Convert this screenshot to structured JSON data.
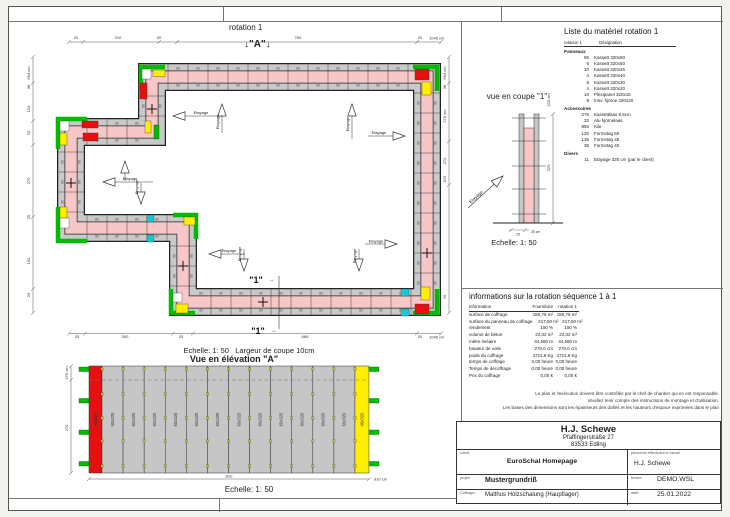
{
  "colors": {
    "wall_pink": "#f7c6c6",
    "panel_gray": "#c9c9c9",
    "green": "#00bb00",
    "red": "#e61010",
    "yellow": "#ffee00",
    "cyan": "#18c8d8",
    "elev_gray": "#c6c6c6"
  },
  "plan": {
    "title": "rotation 1",
    "marker_a": "↓\"A\"↓",
    "marker_1": "\"1\"",
    "marker_arrow": "→",
    "panel_label": "60",
    "etayage_label": "Etayage",
    "scale_note": "Echelle: 1: 50   Largeur de coupe 10cm",
    "dims": {
      "top": [
        "20",
        "210",
        "20",
        "760",
        "20",
        "1045 cm"
      ],
      "left": [
        "664 cm",
        "38",
        "134",
        "20",
        "270",
        "20",
        "190",
        "20"
      ],
      "right": [
        "664 cm",
        "38",
        "270 cm",
        "270",
        "525",
        "20"
      ],
      "bottom": [
        "25",
        "300",
        "25",
        "665",
        "20",
        "1045 cm"
      ]
    }
  },
  "section": {
    "title": "vue en coupe \"1\"",
    "etayage_label": "Etayage",
    "dims": {
      "right": [
        "320 cm",
        "320"
      ],
      "bottom": [
        "25",
        "25 cm"
      ]
    },
    "scale": "Echelle: 1: 50"
  },
  "elevation": {
    "title": "Vue en élévation \"A\"",
    "scale": "Echelle: 1: 50",
    "dims": {
      "left": [
        "270 cm",
        "270"
      ],
      "bottom": [
        "810",
        "810 cm"
      ]
    },
    "panels": [
      {
        "label": "60x320",
        "color": "red"
      },
      {
        "label": "60x320",
        "color": "gray"
      },
      {
        "label": "60x320",
        "color": "gray"
      },
      {
        "label": "60x320",
        "color": "gray"
      },
      {
        "label": "60x320",
        "color": "gray"
      },
      {
        "label": "60x320",
        "color": "gray"
      },
      {
        "label": "60x320",
        "color": "gray"
      },
      {
        "label": "60x320",
        "color": "gray"
      },
      {
        "label": "60x320",
        "color": "gray"
      },
      {
        "label": "60x320",
        "color": "gray"
      },
      {
        "label": "60x320",
        "color": "gray"
      },
      {
        "label": "60x320",
        "color": "gray"
      },
      {
        "label": "60x320",
        "color": "gray"
      },
      {
        "label": "40x320",
        "color": "yellow"
      }
    ]
  },
  "material_list": {
    "title": "Liste du matériel rotation 1",
    "col1": "rotation 1",
    "col2": "Désignation",
    "groups": [
      {
        "name": "Panneaux",
        "items": [
          [
            "95",
            "Kassett 320x60"
          ],
          [
            "6",
            "Kassett 320x50"
          ],
          [
            "10",
            "Kassett 320x45"
          ],
          [
            "4",
            "Kassett 320x40"
          ],
          [
            "6",
            "Kassett 320x30"
          ],
          [
            "4",
            "Kassett 320x20"
          ],
          [
            "10",
            "Plexipanel 320x15"
          ],
          [
            "8",
            "Innv. hjörne 320x20"
          ]
        ]
      },
      {
        "name": "Accessoires",
        "items": [
          [
            "276",
            "Kassettlaas 8,5cm"
          ],
          [
            "32",
            "Alu hjörnelaas"
          ],
          [
            "856",
            "Kile"
          ],
          [
            "120",
            "Formstag 50"
          ],
          [
            "135",
            "Formstag 45"
          ],
          [
            "35",
            "Formstag 40"
          ]
        ]
      },
      {
        "name": "Divers",
        "items": [
          [
            "11",
            "Etayage 320 cm (par le client)"
          ]
        ]
      }
    ]
  },
  "info_table": {
    "title": "informations sur la rotation séquence 1 à 1",
    "headers": [
      "information",
      "Fourniture",
      "rotation 1"
    ],
    "rows": [
      [
        "surface de coffrage",
        "180,79 m²",
        "180,79 m²"
      ],
      [
        "surface du panneau de coffrage",
        "217,60 m²",
        "217,60 m²"
      ],
      [
        "rendement",
        "100 %",
        "100 %"
      ],
      [
        "volume de béton",
        "24,02 m³",
        "24,02 m³"
      ],
      [
        "mètre linéaire",
        "34,580 m",
        "34,580 m"
      ],
      [
        "hauteur de voile",
        "270,0 cm",
        "270,0 cm"
      ],
      [
        "poids du coffrage",
        "4721,9 Kg",
        "4721,9 Kg"
      ],
      [
        "temps de coffrage",
        "0,00 heure",
        "0,00 heure"
      ],
      [
        "Temps de décoffrage",
        "0,00 heure",
        "0,00 heure"
      ],
      [
        "Prix du coffrage",
        "0,00 €",
        "0,00 €"
      ]
    ],
    "disclaimer": [
      "Le plan et l'exécution doivent être contrôlés par le chef de chantier qui en est responsable.",
      "Veuillez tenir compte des instructions de montage et d'utilisation.",
      "Les bases des dimensions sont les épaisseurs des dalles et les hauteurs d'espace exprimées dans le plan"
    ]
  },
  "title_block": {
    "company": "H.J. Schewe",
    "address1": "Pfaffingerstraße 27",
    "address2": "83533 Edling",
    "client_label": "client:",
    "client": "EuroSchal Homepage",
    "worker_label": "personne effectuant le travail",
    "worker": "H.J. Schewe",
    "project_label": "projet:",
    "project": "Mustergrundriß",
    "file_label": "fichier:",
    "file": "DEMO.WSL",
    "formwork_label": "Coffrage:",
    "formwork": "Malthus Holzschalung (Hauptlager)",
    "date_label": "date:",
    "date": "25.01.2022"
  }
}
